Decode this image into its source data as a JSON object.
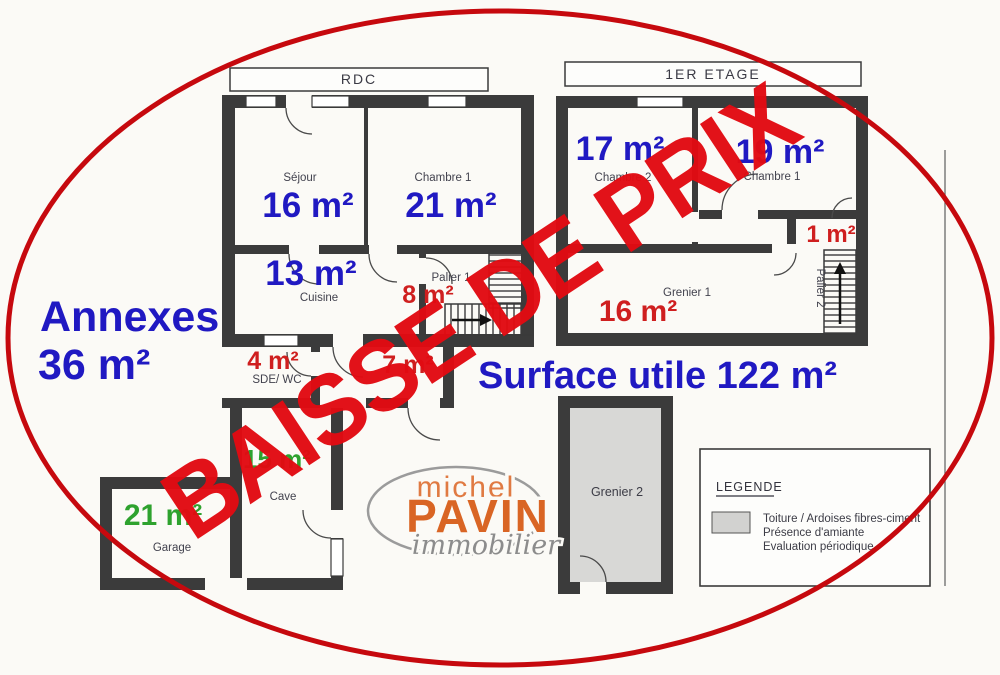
{
  "watermark": {
    "text": "BAISSE DE PRIX"
  },
  "overlay": {
    "annexes_line1": "Annexes",
    "annexes_line2": "36 m²",
    "surface": "Surface utile 122 m²"
  },
  "colors": {
    "blue": "#2019c2",
    "red": "#cf1f1f",
    "green": "#2ea22e",
    "watermark_red": "#e20b12",
    "ellipse_red": "#c6090e",
    "wall": "#3b3b3b",
    "logo_orange": "#d96524",
    "grenier2_fill": "#d8d8d6"
  },
  "rdc": {
    "title": "RDC",
    "sejour": {
      "name": "Séjour",
      "area": "16 m²"
    },
    "chambre1": {
      "name": "Chambre 1",
      "area": "21 m²"
    },
    "cuisine": {
      "name": "Cuisine",
      "area": "13 m²"
    },
    "palier1": {
      "name": "Palier 1",
      "area": "8 m²"
    },
    "sde_wc": {
      "name": "SDE/ WC",
      "area": "4 m²"
    },
    "entree": {
      "area": "7 m²"
    },
    "cave": {
      "name": "Cave",
      "area": "15 m²"
    },
    "garage": {
      "name": "Garage",
      "area": "21 m²"
    }
  },
  "etage": {
    "title": "1ER ETAGE",
    "chambre2": {
      "name": "Chambre 2",
      "area": "17 m²"
    },
    "chambre1": {
      "name": "Chambre 1",
      "area": "19 m²"
    },
    "palier2": {
      "name": "Palier 2",
      "area": "1 m²"
    },
    "grenier1": {
      "name": "Grenier 1",
      "area": "16 m²"
    },
    "grenier2": {
      "name": "Grenier 2"
    }
  },
  "legend": {
    "title": "LEGENDE",
    "line1": "Toiture / Ardoises fibres-ciment",
    "line2": "Présence d'amiante",
    "line3": "Evaluation périodique"
  },
  "logo": {
    "top": "michel",
    "main": "PAVIN",
    "sub": "immobilier"
  }
}
